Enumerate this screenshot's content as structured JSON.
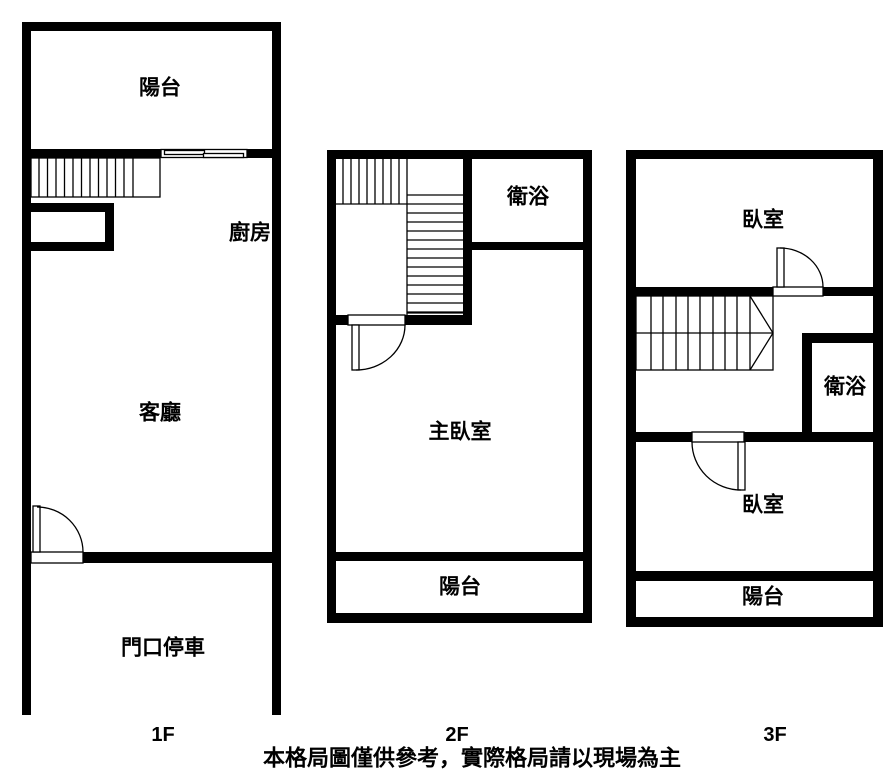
{
  "colors": {
    "wall": "#000000",
    "background": "#ffffff"
  },
  "caption": "本格局圖僅供參考，實際格局請以現場為主",
  "floors": {
    "f1": {
      "label": "1F",
      "rooms": {
        "balcony": "陽台",
        "kitchen": "廚房",
        "living_room": "客廳",
        "parking": "門口停車"
      }
    },
    "f2": {
      "label": "2F",
      "rooms": {
        "bathroom": "衛浴",
        "master_bedroom": "主臥室",
        "balcony": "陽台"
      }
    },
    "f3": {
      "label": "3F",
      "rooms": {
        "bedroom_upper": "臥室",
        "bathroom": "衛浴",
        "bedroom_lower": "臥室",
        "balcony": "陽台"
      }
    }
  }
}
